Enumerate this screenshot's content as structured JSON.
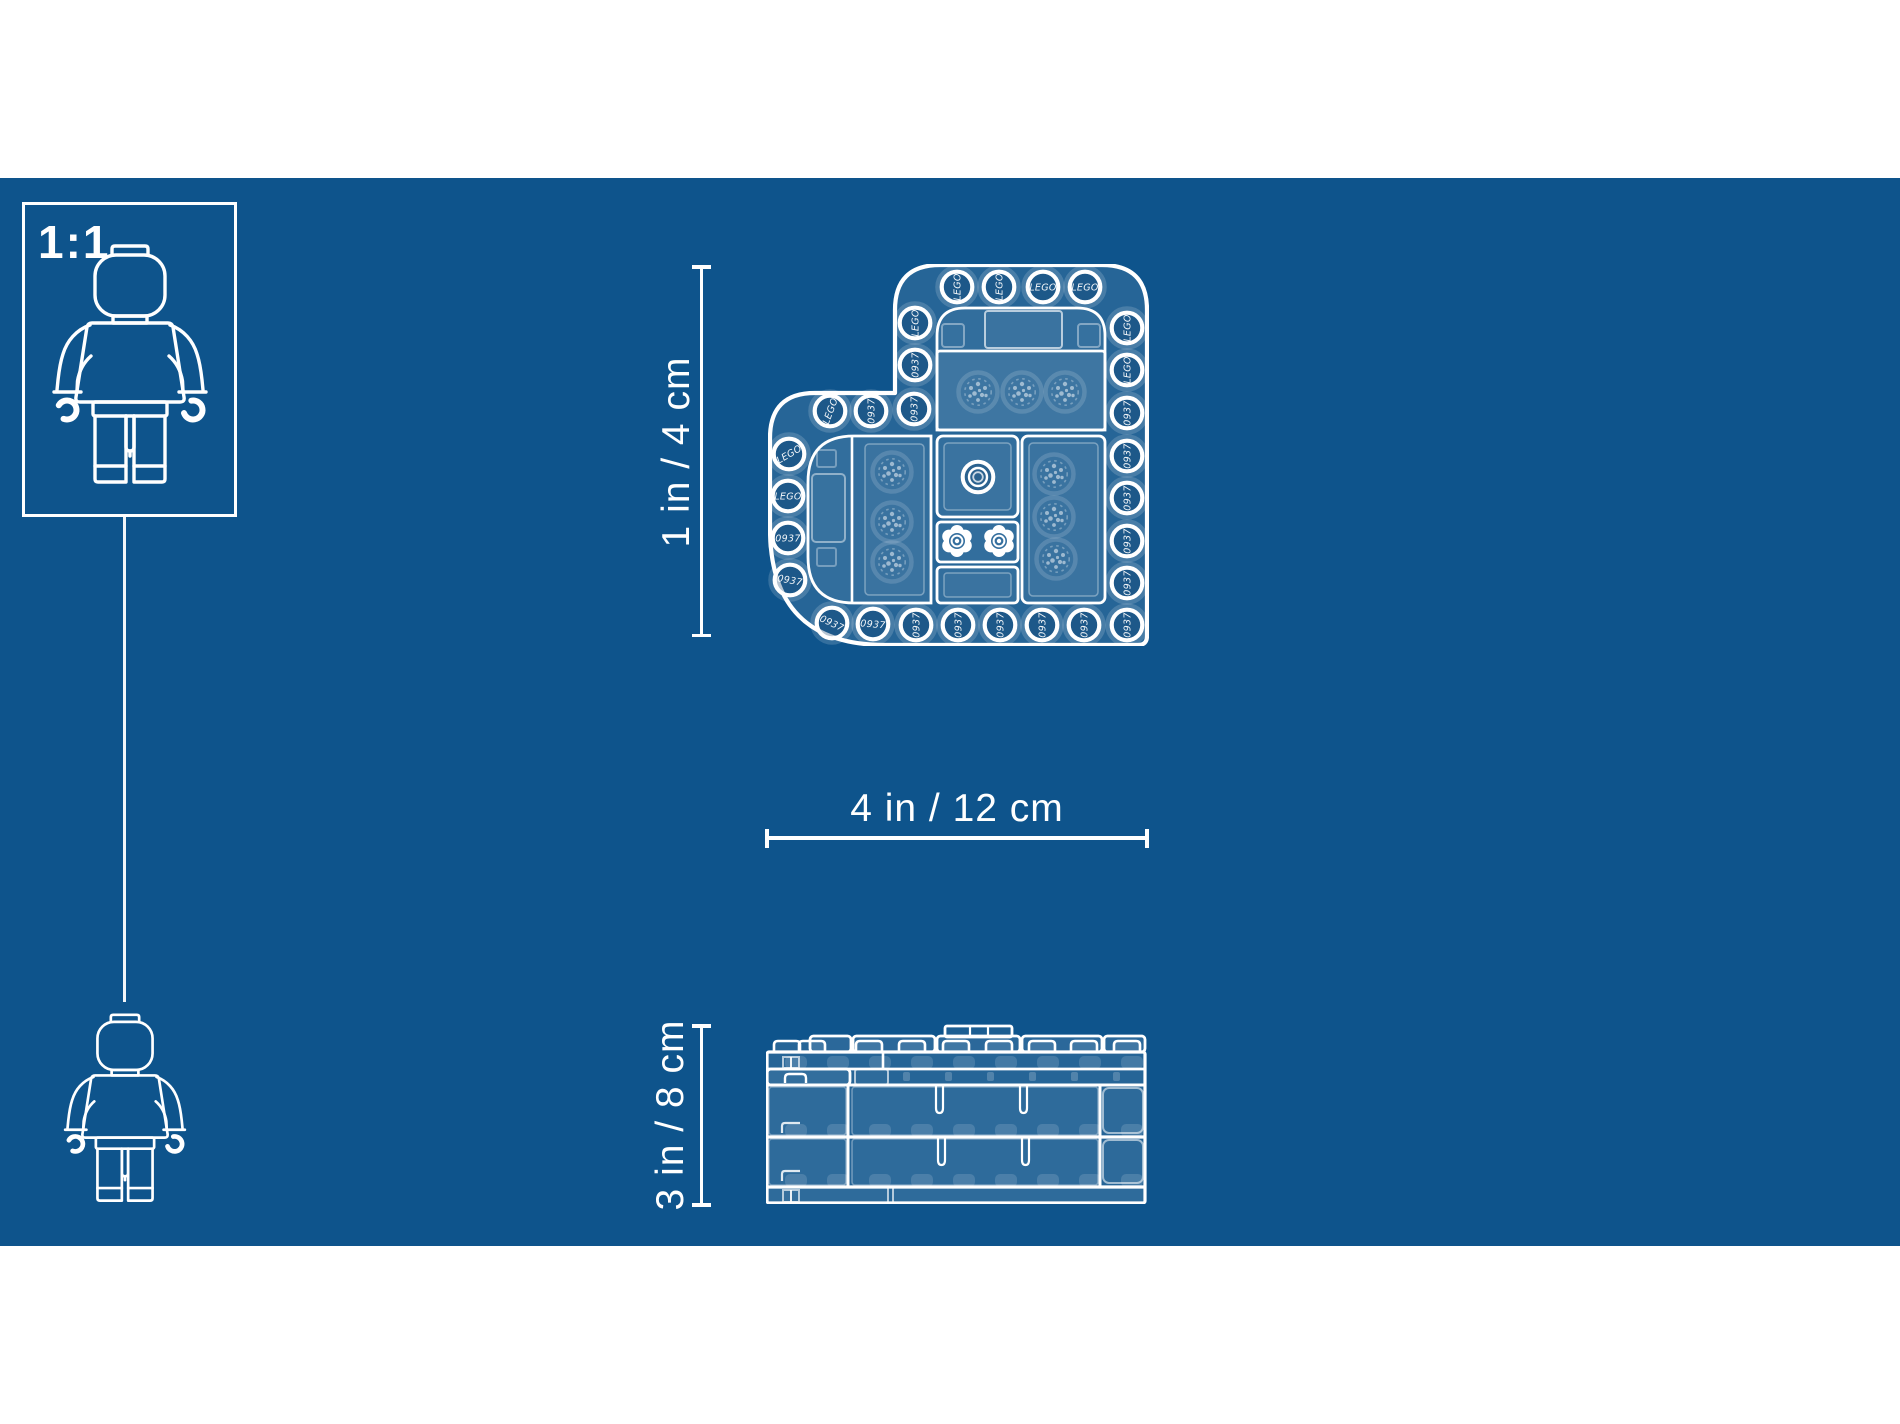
{
  "canvas": {
    "background_color": "#0e548c",
    "line_color": "#ffffff"
  },
  "scale_indicator": {
    "label": "1:1"
  },
  "dimensions": {
    "heart_height": {
      "label": "1 in / 4 cm",
      "orientation": "vertical"
    },
    "heart_width": {
      "label": "4 in / 12 cm",
      "orientation": "horizontal"
    },
    "box_side_height": {
      "label": "3 in / 8 cm",
      "orientation": "vertical"
    }
  },
  "stud_markings": {
    "brand": "LEGO",
    "mold_number": "0937"
  },
  "heart_studs": [
    {
      "x": 189,
      "y": 23,
      "l": "brand",
      "r": -90
    },
    {
      "x": 231,
      "y": 23,
      "l": "brand",
      "r": -90
    },
    {
      "x": 275,
      "y": 23,
      "l": "brand",
      "r": 0
    },
    {
      "x": 317,
      "y": 23,
      "l": "brand",
      "r": 0
    },
    {
      "x": 147,
      "y": 59,
      "l": "brand",
      "r": -90
    },
    {
      "x": 147,
      "y": 101,
      "l": "mold",
      "r": -90
    },
    {
      "x": 146,
      "y": 145,
      "l": "mold",
      "r": -90
    },
    {
      "x": 62,
      "y": 147,
      "l": "brand",
      "r": -70
    },
    {
      "x": 103,
      "y": 147,
      "l": "mold",
      "r": -90
    },
    {
      "x": 21,
      "y": 190,
      "l": "brand",
      "r": -30
    },
    {
      "x": 20,
      "y": 232,
      "l": "brand",
      "r": 0
    },
    {
      "x": 20,
      "y": 274,
      "l": "mold",
      "r": 0
    },
    {
      "x": 22,
      "y": 316,
      "l": "mold",
      "r": 10
    },
    {
      "x": 64,
      "y": 359,
      "l": "mold",
      "r": 25
    },
    {
      "x": 105,
      "y": 360,
      "l": "mold",
      "r": 5
    },
    {
      "x": 148,
      "y": 361,
      "l": "mold",
      "r": -90
    },
    {
      "x": 190,
      "y": 361,
      "l": "mold",
      "r": -90
    },
    {
      "x": 232,
      "y": 361,
      "l": "mold",
      "r": -90
    },
    {
      "x": 274,
      "y": 361,
      "l": "mold",
      "r": -90
    },
    {
      "x": 316,
      "y": 361,
      "l": "mold",
      "r": -90
    },
    {
      "x": 359,
      "y": 361,
      "l": "mold",
      "r": -90
    },
    {
      "x": 359,
      "y": 64,
      "l": "brand",
      "r": -90
    },
    {
      "x": 359,
      "y": 106,
      "l": "brand",
      "r": -90
    },
    {
      "x": 359,
      "y": 149,
      "l": "mold",
      "r": -90
    },
    {
      "x": 359,
      "y": 192,
      "l": "mold",
      "r": -90
    },
    {
      "x": 359,
      "y": 234,
      "l": "mold",
      "r": -90
    },
    {
      "x": 359,
      "y": 277,
      "l": "mold",
      "r": -90
    },
    {
      "x": 359,
      "y": 319,
      "l": "mold",
      "r": -90
    }
  ]
}
